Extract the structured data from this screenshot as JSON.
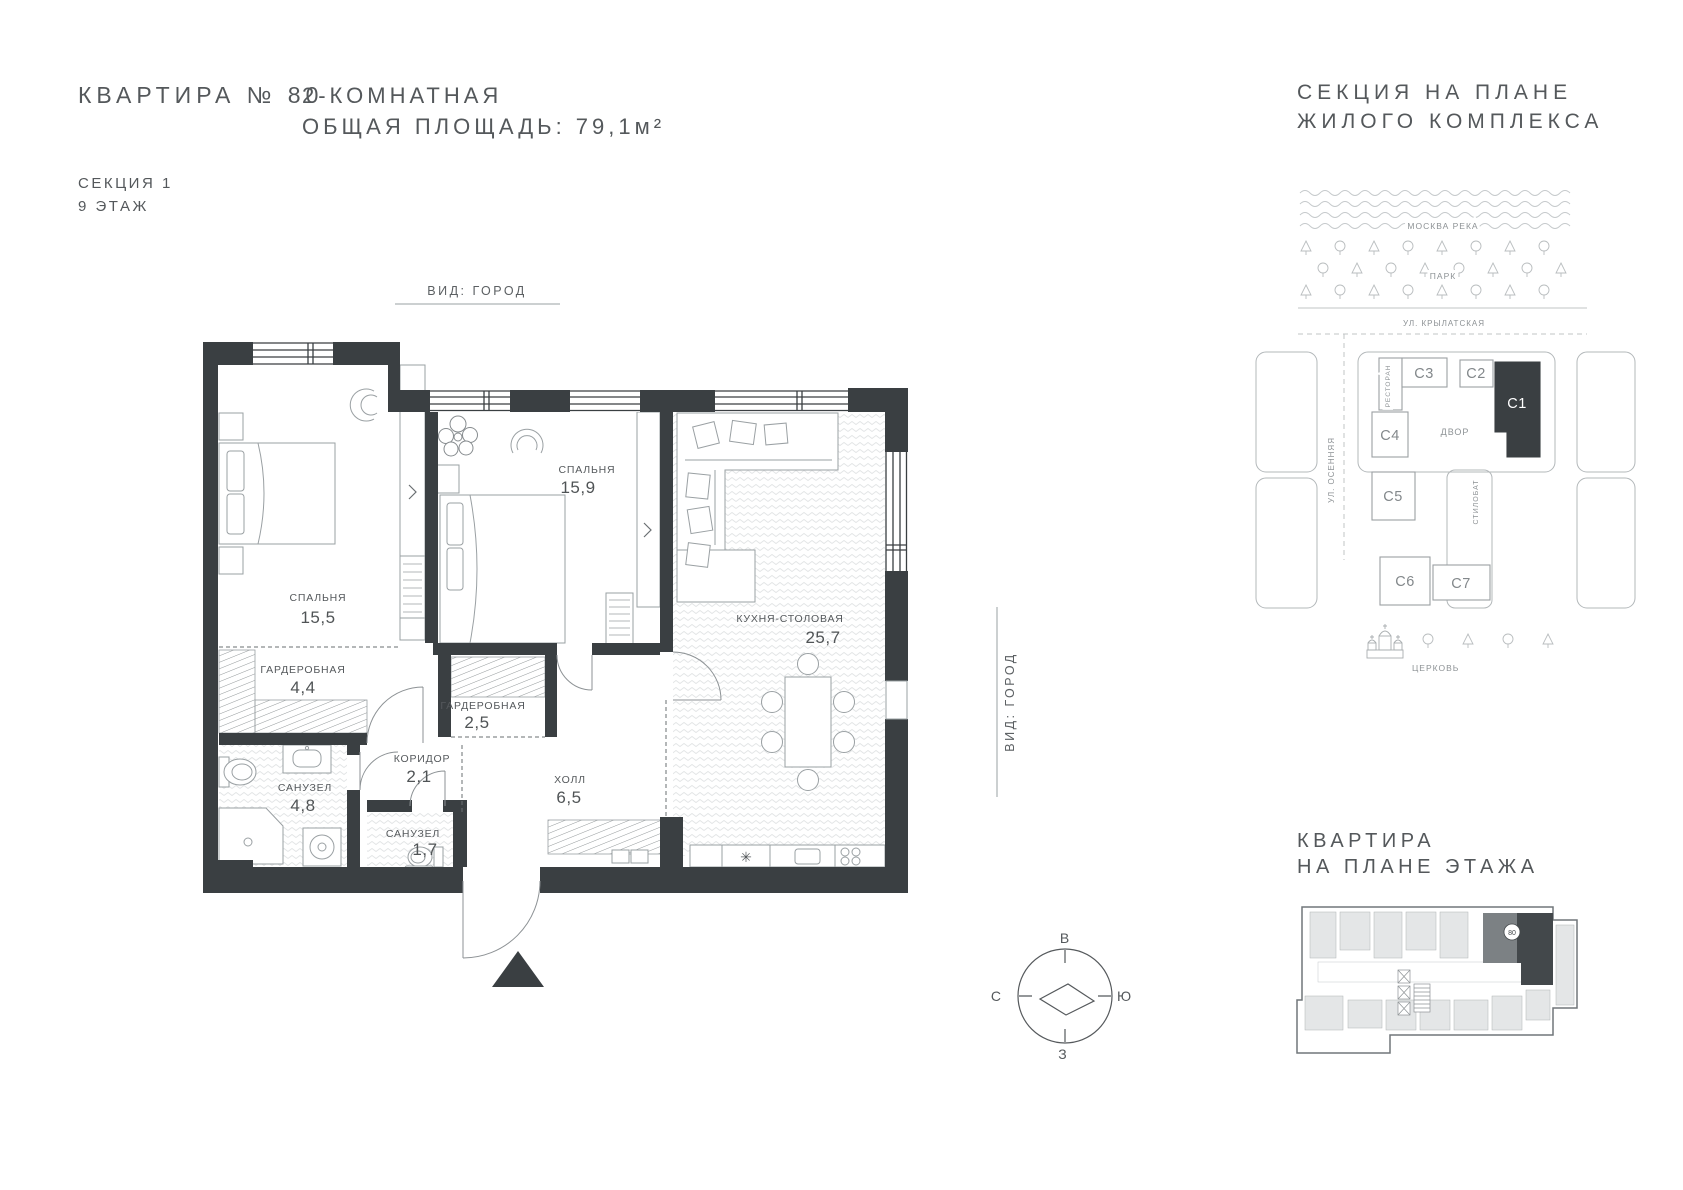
{
  "header": {
    "apartment_title": "КВАРТИРА № 80",
    "section": "СЕКЦИЯ 1",
    "floor": "9 ЭТАЖ",
    "type_line": "2-КОМНАТНАЯ",
    "area_line": "ОБЩАЯ ПЛОЩАДЬ: 79,1м²"
  },
  "floor_plan": {
    "view_top": "ВИД: ГОРОД",
    "view_right": "ВИД: ГОРОД",
    "rooms": {
      "bedroom1": {
        "name": "СПАЛЬНЯ",
        "area": "15,5"
      },
      "bedroom2": {
        "name": "СПАЛЬНЯ",
        "area": "15,9"
      },
      "kitchen": {
        "name": "КУХНЯ-СТОЛОВАЯ",
        "area": "25,7"
      },
      "wardrobe1": {
        "name": "ГАРДЕРОБНАЯ",
        "area": "4,4"
      },
      "wardrobe2": {
        "name": "ГАРДЕРОБНАЯ",
        "area": "2,5"
      },
      "corridor": {
        "name": "КОРИДОР",
        "area": "2,1"
      },
      "bathroom1": {
        "name": "САНУЗЕЛ",
        "area": "4,8"
      },
      "bathroom2": {
        "name": "САНУЗЕЛ",
        "area": "1,7"
      },
      "hall": {
        "name": "ХОЛЛ",
        "area": "6,5"
      }
    },
    "compass": {
      "top": "В",
      "right": "Ю",
      "bottom": "З",
      "left": "С"
    }
  },
  "site_plan": {
    "title_line1": "СЕКЦИЯ НА ПЛАНЕ",
    "title_line2": "ЖИЛОГО КОМПЛЕКСА",
    "river": "МОСКВА РЕКА",
    "park": "ПАРК",
    "street_top": "УЛ. КРЫЛАТСКАЯ",
    "street_left": "УЛ. ОСЕННЯЯ",
    "courtyard": "ДВОР",
    "restaurant": "РЕСТОРАН",
    "stylobate": "СТИЛОБАТ",
    "church": "ЦЕРКОВЬ",
    "sections": {
      "c1": "С1",
      "c2": "С2",
      "c3": "С3",
      "c4": "С4",
      "c5": "С5",
      "c6": "С6",
      "c7": "С7"
    },
    "highlighted_section": "С1"
  },
  "floor_thumb": {
    "title_line1": "КВАРТИРА",
    "title_line2": "НА ПЛАНЕ ЭТАЖА",
    "badge": "80"
  },
  "colors": {
    "wall": "#3a3f42",
    "ink": "#54585b",
    "muted": "#8d9295",
    "line": "#b3b8ba"
  }
}
